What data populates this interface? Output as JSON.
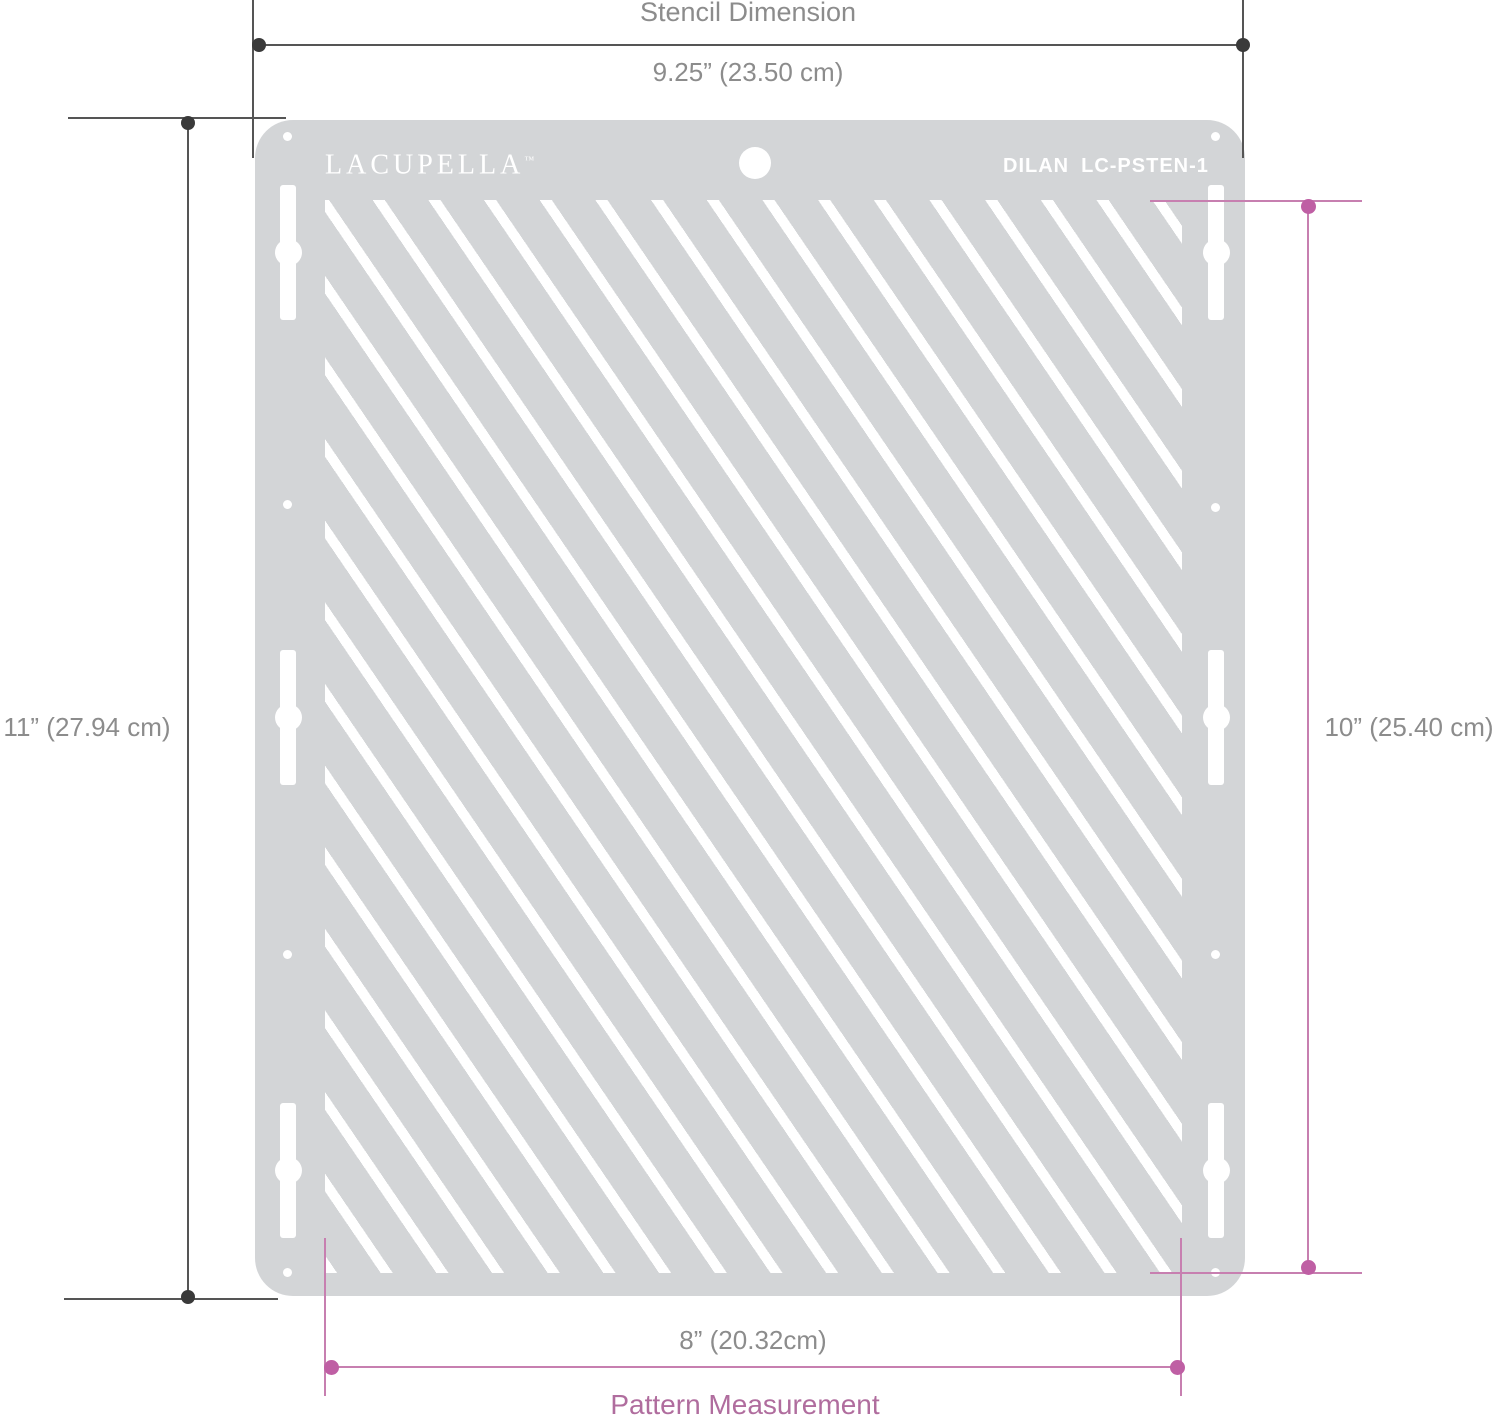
{
  "diagram": {
    "stencil": {
      "brand": "LACUPELLA",
      "trademark": "™",
      "model": "DILAN",
      "product_code": "LC-PSTEN-1"
    },
    "dimensions": {
      "stencil_width": {
        "title": "Stencil Dimension",
        "value": "9.25” (23.50 cm)"
      },
      "stencil_height": {
        "value": "11” (27.94 cm)"
      },
      "pattern_height": {
        "value": "10” (25.40 cm)"
      },
      "pattern_width": {
        "value": "8” (20.32cm)",
        "title": "Pattern Measurement"
      }
    },
    "colors": {
      "stencil_body": "#d3d5d7",
      "stencil_cutout": "#ffffff",
      "dark_line": "#555555",
      "dark_dot": "#3a3a3a",
      "gray_text": "#8c8c8c",
      "pink_line": "#c77fb0",
      "pink_dot": "#bf5fa4",
      "pink_text": "#b06d9e"
    }
  }
}
